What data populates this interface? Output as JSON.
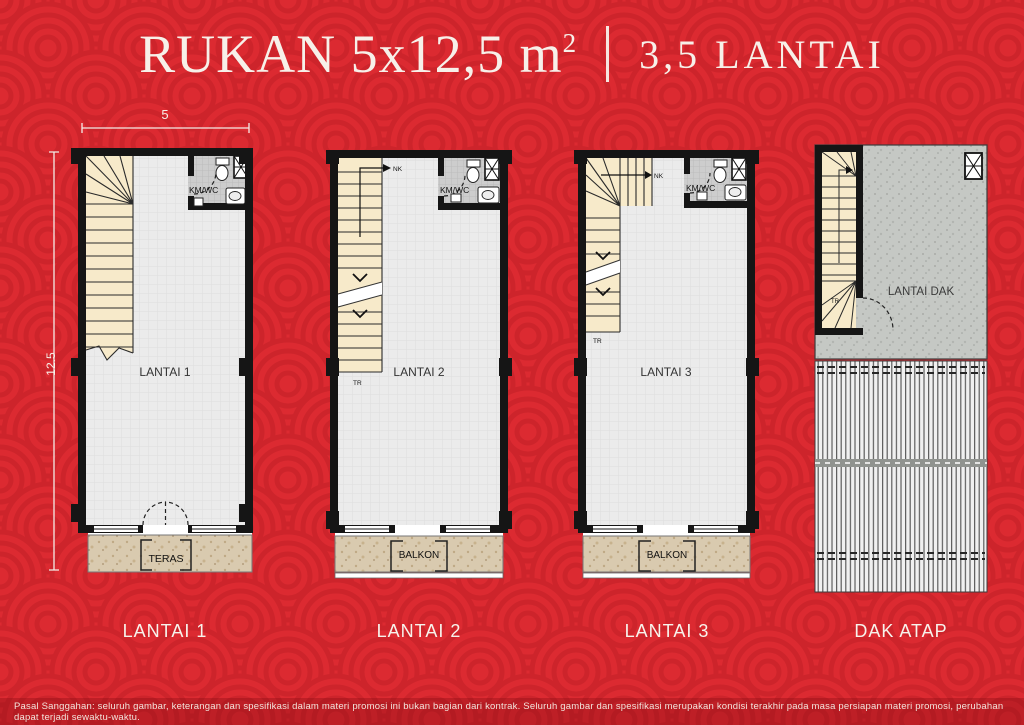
{
  "header": {
    "title_main": "RUKAN 5x12,5 m",
    "title_sup": "2",
    "title_floors": "3,5 LANTAI"
  },
  "dimensions": {
    "width": "5",
    "depth": "12.5"
  },
  "plan_labels": {
    "bath": "KM/WC",
    "floor1": "LANTAI 1",
    "floor2": "LANTAI 2",
    "floor3": "LANTAI 3",
    "roof_deck": "LANTAI DAK",
    "terrace": "TERAS",
    "balcony": "BALKON",
    "stair_up": "NK",
    "stair_down": "TR"
  },
  "captions": [
    "LANTAI 1",
    "LANTAI 2",
    "LANTAI 3",
    "DAK ATAP"
  ],
  "footer": {
    "disclaimer": "Pasal Sanggahan: seluruh gambar, keterangan dan spesifikasi dalam materi promosi ini bukan bagian dari kontrak. Seluruh gambar dan spesifikasi merupakan kondisi terakhir pada masa persiapan materi promosi, perubahan dapat terjadi sewaktu-waktu."
  },
  "colors": {
    "background_red": "#DC2A31",
    "pattern_arc_red": "#CD242B",
    "wall_black": "#151515",
    "floor_gray": "#EBEBEB",
    "stair_cream": "#F7EACA",
    "tile_gray": "#CDCDCD",
    "terrace_tan": "#D9CAAF",
    "text_white": "#F7F0E9"
  }
}
